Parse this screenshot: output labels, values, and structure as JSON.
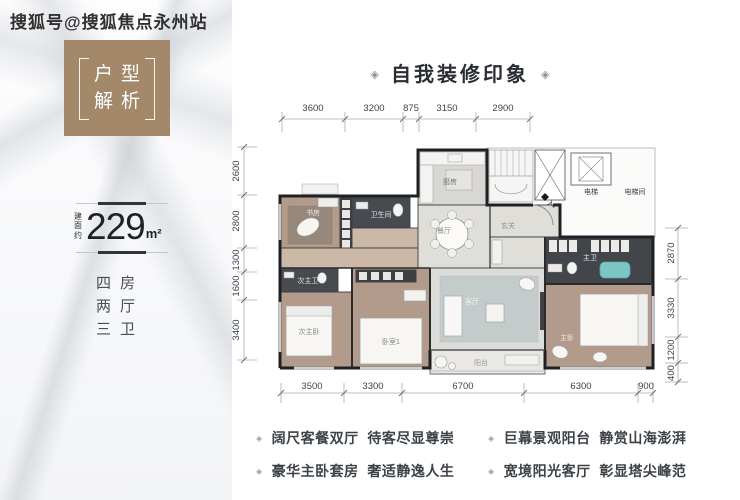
{
  "watermark": "搜狐号@搜狐焦点永州站",
  "tag_box": {
    "line1": "户型",
    "line2": "解析"
  },
  "area": {
    "prefix": "建面约",
    "value": "229",
    "unit": "m²"
  },
  "layout": {
    "lines": [
      "四房",
      "两厅",
      "三卫"
    ]
  },
  "title": {
    "ornament": "◈",
    "text": "自我装修印象"
  },
  "plan": {
    "dims": {
      "top": [
        "3600",
        "3200",
        "875",
        "3150",
        "2900"
      ],
      "left": [
        "2600",
        "2800",
        "1300",
        "1600",
        "3400"
      ],
      "right": [
        "2870",
        "3330",
        "1200",
        "400"
      ],
      "bottom": [
        "3500",
        "3300",
        "6700",
        "6300",
        "900"
      ]
    },
    "rooms": {
      "study": "书房",
      "bath": "卫生间",
      "jr_bath": "次主卫",
      "jr_bed": "次主卧",
      "bedroom1": "卧室1",
      "kitchen": "厨房",
      "dining": "餐厅",
      "foyer": "玄关",
      "entry": "入户",
      "elevator": "电梯",
      "elevator_hall": "电梯间",
      "master_bath": "主卫",
      "master_bed": "主卧",
      "living": "客厅",
      "balcony": "阳台"
    }
  },
  "features": {
    "bullet": "◈",
    "items": [
      "阔尺客餐双厅  待客尽显尊崇",
      "巨幕景观阳台  静赏山海澎湃",
      "豪华主卧套房  奢适静逸人生",
      "宽境阳光客厅  彰显塔尖峰范"
    ]
  },
  "colors": {
    "accent_brown": "#a3886a",
    "wall": "#1f2023",
    "wood_floor": "#b29b8a",
    "dark_tile": "#474a4f",
    "rug_blue": "#c3cccb",
    "tub_teal": "#7cc6c4"
  }
}
